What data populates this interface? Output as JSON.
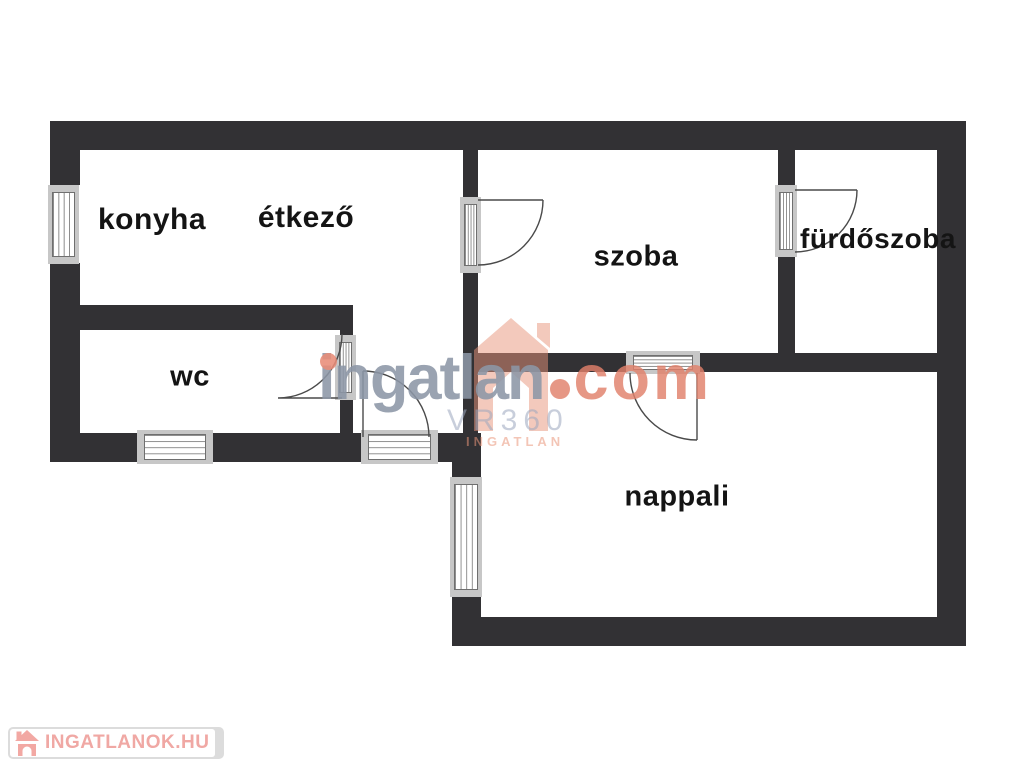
{
  "floorplan": {
    "rooms": [
      {
        "id": "konyha",
        "label": "konyha"
      },
      {
        "id": "etkezo",
        "label": "étkező"
      },
      {
        "id": "wc",
        "label": "wc"
      },
      {
        "id": "szoba",
        "label": "szoba"
      },
      {
        "id": "furdoszoba",
        "label": "fürdőszoba"
      },
      {
        "id": "nappali",
        "label": "nappali"
      }
    ],
    "colors": {
      "wall": "#323134",
      "window_frame": "#c7c7c7",
      "door_line": "#4a4a4a"
    }
  },
  "watermark": {
    "brand": "ingatlan",
    "tld": "com",
    "vr_label": "VR360",
    "sub_label": "INGATLAN",
    "colors": {
      "brand_gray": "#8c96a6",
      "accent_salmon": "#e0806a"
    }
  },
  "footer_logo": {
    "text": "INGATLANOK.HU",
    "color": "#f0a8a4"
  }
}
